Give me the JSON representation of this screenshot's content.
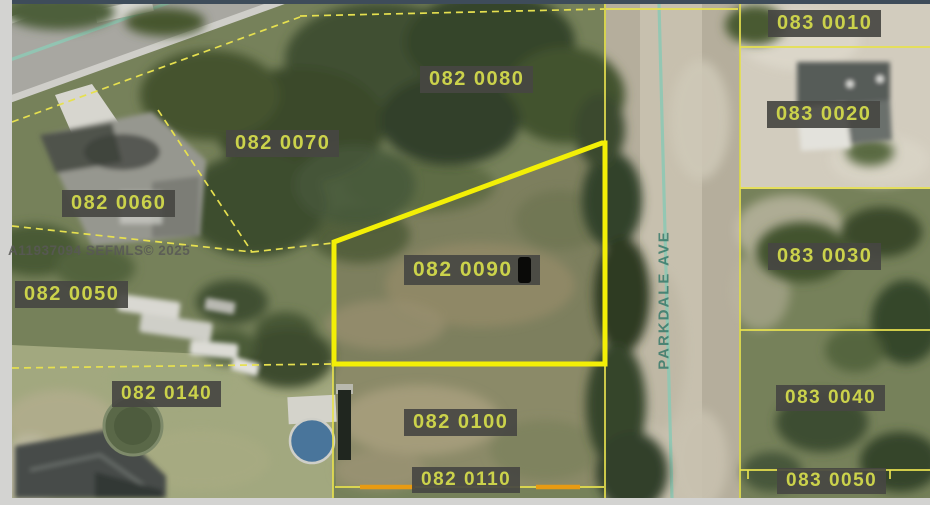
{
  "map": {
    "watermark": "A11937094 SEFMLS© 2025",
    "street": {
      "name": "PARKDALE AVE"
    },
    "colors": {
      "parcel_line": "#e6e04f",
      "selected_outline": "#f3ef06",
      "orange_segment": "#e89b12",
      "label_bg": "#464642",
      "label_text": "#cbd24b",
      "road_centerline": "#8fc8b4",
      "frame": "#d3d3d1",
      "top_strip": "#3e4c5a"
    },
    "selected_parcel": "082 0090",
    "parcels": [
      {
        "id": "082 0080",
        "selected": false
      },
      {
        "id": "082 0070",
        "selected": false
      },
      {
        "id": "082 0060",
        "selected": false
      },
      {
        "id": "082 0050",
        "selected": false
      },
      {
        "id": "082 0090",
        "selected": true
      },
      {
        "id": "082 0140",
        "selected": false
      },
      {
        "id": "082 0100",
        "selected": false
      },
      {
        "id": "082 0110",
        "selected": false
      },
      {
        "id": "083 0010",
        "selected": false
      },
      {
        "id": "083 0020",
        "selected": false
      },
      {
        "id": "083 0030",
        "selected": false
      },
      {
        "id": "083 0040",
        "selected": false
      },
      {
        "id": "083 0050",
        "selected": false
      }
    ]
  }
}
